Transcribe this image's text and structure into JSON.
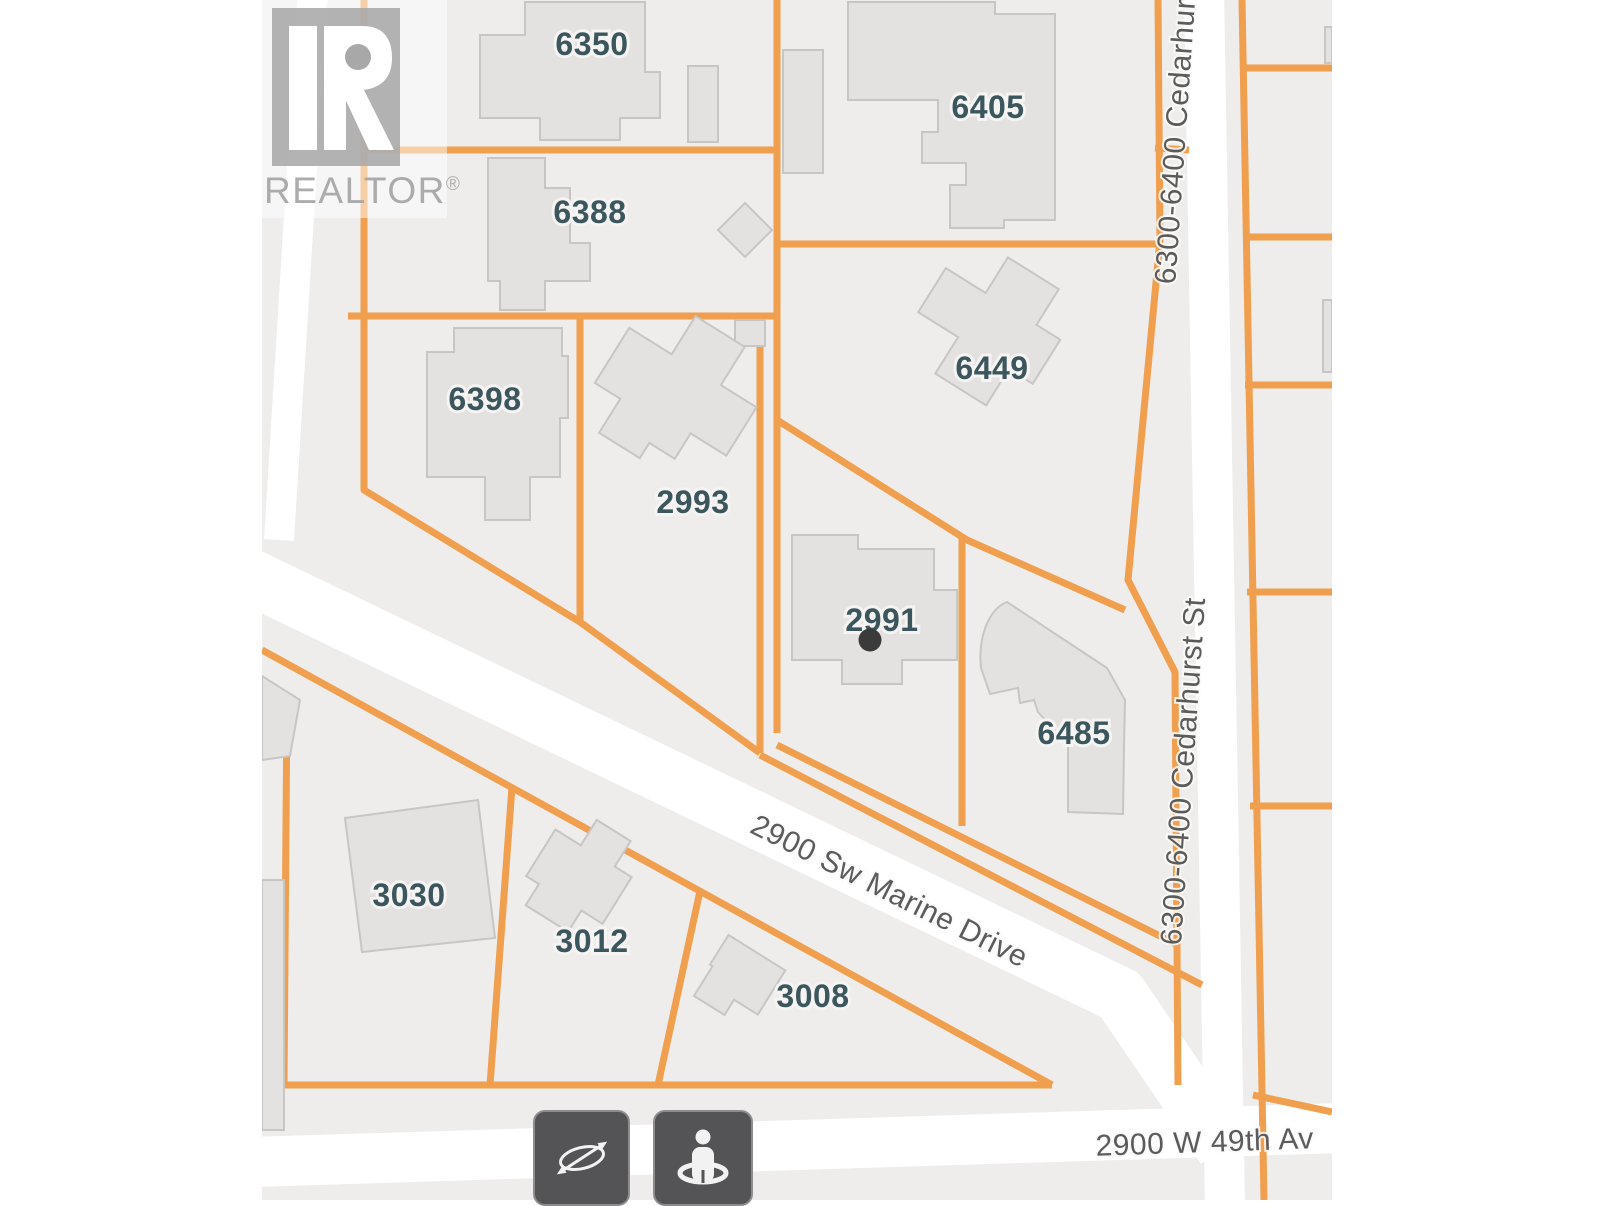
{
  "watermark": {
    "brand": "REALTOR",
    "registered_mark": "®"
  },
  "map": {
    "colors": {
      "map_bg": "#eeedec",
      "road": "#ffffff",
      "parcel_line": "#ef9f4d",
      "building_fill": "#e3e2e1",
      "building_stroke": "#c7c6c5",
      "lot_label": "#3b565c",
      "street_label": "#5b5b5b",
      "marker": "#3b3b3b",
      "watermark_gray": "#a8a8a8",
      "button_bg": "#545457",
      "button_icon": "#f2f2f2"
    },
    "lots": [
      {
        "label": "6350"
      },
      {
        "label": "6388"
      },
      {
        "label": "6398"
      },
      {
        "label": "2993"
      },
      {
        "label": "6405"
      },
      {
        "label": "6449"
      },
      {
        "label": "2991"
      },
      {
        "label": "6485"
      },
      {
        "label": "3030"
      },
      {
        "label": "3012"
      },
      {
        "label": "3008"
      }
    ],
    "streets": [
      {
        "label": "6300-6400 Cedarhurst"
      },
      {
        "label": "6300-6400 Cedarhurst St"
      },
      {
        "label": "2900 Sw Marine Drive"
      },
      {
        "label": "2900 W 49th Av"
      }
    ],
    "marker": {
      "lot": "2991"
    },
    "controls": [
      {
        "name": "compass-button",
        "icon": "compass-icon"
      },
      {
        "name": "pegman-button",
        "icon": "pegman-icon"
      }
    ]
  }
}
